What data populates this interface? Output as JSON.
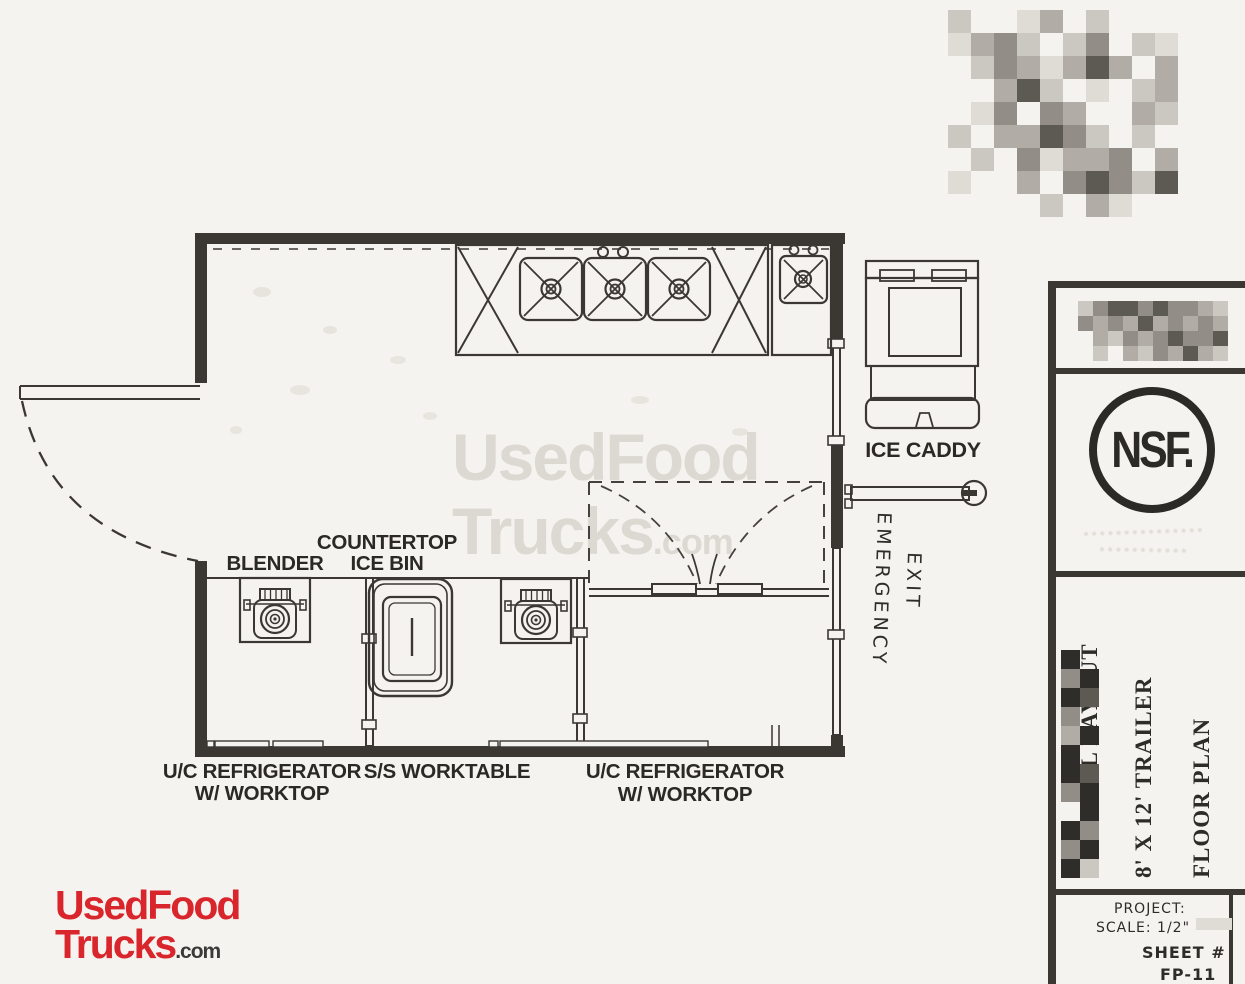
{
  "plan": {
    "labels": {
      "blender": "BLENDER",
      "countertop_line1": "COUNTERTOP",
      "countertop_line2": "ICE BIN",
      "ice_caddy": "ICE CADDY",
      "emergency_line1": "EMERGENCY",
      "emergency_line2": "EXIT",
      "fridge_left_line1": "U/C REFRIGERATOR",
      "fridge_left_line2": "W/ WORKTOP",
      "worktable": "S/S WORKTABLE",
      "fridge_right_line1": "U/C REFRIGERATOR",
      "fridge_right_line2": "W/ WORKTOP"
    }
  },
  "watermark": {
    "line1": "UsedFood",
    "line2": "Trucks",
    "suffix": ".com"
  },
  "site_logo": {
    "line1": "UsedFood",
    "line2": "Trucks",
    "suffix": ".com"
  },
  "title_block": {
    "certification": "NSF.",
    "rotated_lines": [
      "ORIGINAL LAYOUT",
      "8' X 12' TRAILER",
      "FLOOR PLAN"
    ],
    "project_label": "PROJECT:",
    "scale_text": "SCALE: 1/2\" -",
    "sheet_label": "SHEET #",
    "sheet_number": "FP-11"
  },
  "colors": {
    "ink": "#3b3834",
    "paper": "#f5f3ef",
    "watermark_gray": "#dcd8d2",
    "logo_red": "#d9262c"
  }
}
